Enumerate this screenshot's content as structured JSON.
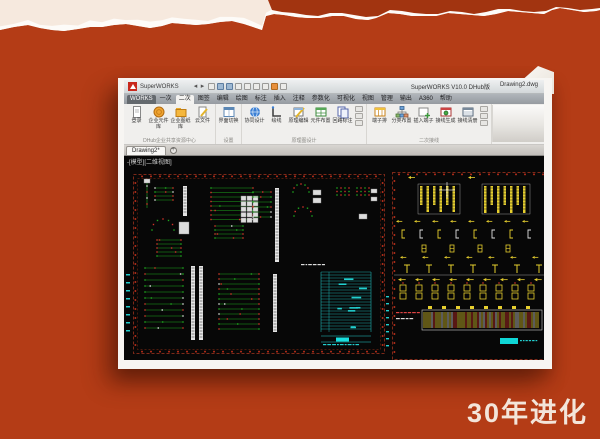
{
  "slide": {
    "caption": "30年进化"
  },
  "colors": {
    "slide_bg": "#b43c16",
    "torn_strip": "#a23410",
    "torn_paper": "#f6e9de",
    "logo_red": "#c8281c",
    "canvas_bg": "#070707",
    "schematic_green": "#1fa81f",
    "schematic_red": "#d2322a",
    "schematic_cyan": "#22cfcf",
    "schematic_yellow": "#e6cf2e",
    "sheet_frame": "#7c2818"
  },
  "window": {
    "app_name": "SuperWORKS",
    "title_version": "SuperWORKS V10.0 DHub版",
    "title_doc": "Drawing2.dwg",
    "qat_icons": [
      "back-icon",
      "forward-icon",
      "new-icon",
      "open-icon",
      "save-icon",
      "print-icon",
      "undo-icon",
      "redo-icon",
      "refresh-icon",
      "settings-icon",
      "close-icon"
    ],
    "menu_tabs": [
      "WORKS",
      "一次",
      "二次",
      "图签",
      "编辑",
      "绘图",
      "标注",
      "插入",
      "注释",
      "参数化",
      "可视化",
      "视图",
      "管理",
      "输出",
      "A360",
      "帮助"
    ],
    "selected_tab": "二次",
    "ribbon_groups": [
      {
        "caption": "DHub企业共享资源中心",
        "mini": 0,
        "buttons": [
          {
            "label": "登录",
            "icon": "doc"
          },
          {
            "label": "企业元件库",
            "icon": "coin"
          },
          {
            "label": "企业图纸库",
            "icon": "folder"
          },
          {
            "label": "云文件",
            "icon": "doc-pen"
          }
        ]
      },
      {
        "caption": "设置",
        "mini": 0,
        "buttons": [
          {
            "label": "界面切换",
            "icon": "window"
          }
        ]
      },
      {
        "caption": "原理图设计",
        "mini": 3,
        "buttons": [
          {
            "label": "协同设计",
            "icon": "globe"
          },
          {
            "label": "绘线",
            "icon": "lline"
          },
          {
            "label": "原理编辑",
            "icon": "pencil-grid"
          },
          {
            "label": "元件布置",
            "icon": "grid-green"
          },
          {
            "label": "回路标注",
            "icon": "pages"
          }
        ]
      },
      {
        "caption": "二次接线",
        "mini": 3,
        "buttons": [
          {
            "label": "端子排",
            "icon": "grid-orange"
          },
          {
            "label": "分类布置",
            "icon": "tree"
          },
          {
            "label": "插入端子",
            "icon": "plus-box"
          },
          {
            "label": "接线生成",
            "icon": "table-red"
          },
          {
            "label": "接线清册",
            "icon": "table-blue"
          }
        ]
      }
    ],
    "file_tab": "Drawing2*",
    "new_tab_label": "+",
    "canvas_label": "-[模型][二维视图]"
  }
}
